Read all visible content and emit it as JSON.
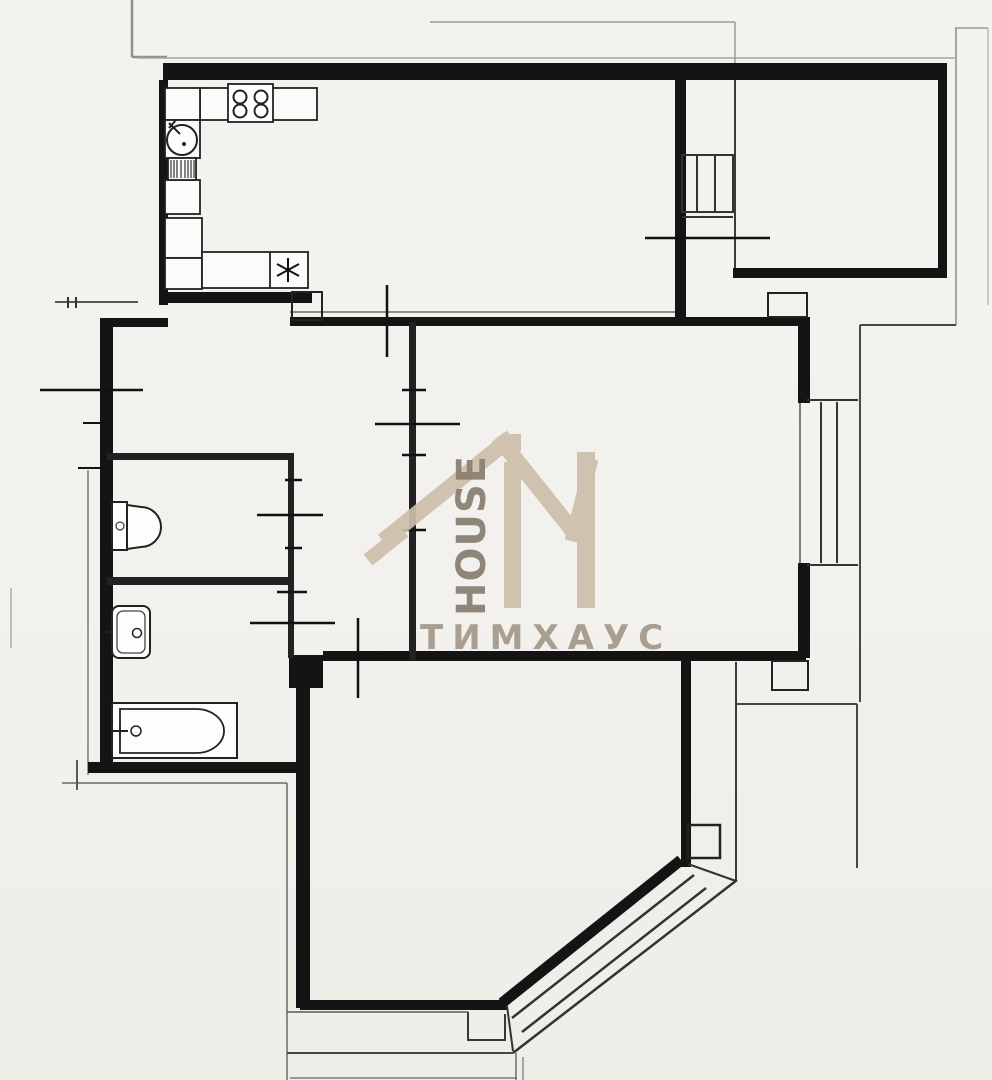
{
  "watermark": {
    "logo_monogram": "TiM",
    "logo_subtext": "HOUSE",
    "brand_name_cyrillic": "ТИМХАУС",
    "colors": {
      "logo_beige": "#ccc0ab",
      "house_text": "#8a8174",
      "cyrillic_text": "#a49b8d"
    }
  },
  "plan": {
    "kind": "scanned apartment floor plan, no text labels",
    "paper_color": "#f3f1ed",
    "wall_color": "#141414",
    "fixtures": [
      {
        "icon": "stove-icon",
        "location": "kitchen top wall",
        "detail": "4 burners"
      },
      {
        "icon": "kitchen-sink-icon",
        "location": "kitchen left counter",
        "detail": "round sink with tap"
      },
      {
        "icon": "striped-appliance-icon",
        "location": "kitchen left counter"
      },
      {
        "icon": "fridge-marker-icon",
        "location": "kitchen lower counter",
        "detail": "asterisk symbol"
      },
      {
        "icon": "toilet-icon",
        "location": "WC room left side"
      },
      {
        "icon": "washbasin-icon",
        "location": "washroom left side"
      },
      {
        "icon": "bathtub-icon",
        "location": "bathroom lower left"
      },
      {
        "icon": "window-icon",
        "location": "living room right wall"
      },
      {
        "icon": "ladder-icon",
        "location": "upper right annex"
      },
      {
        "icon": "stairs-icon",
        "location": "lower right diagonal external stairs"
      }
    ]
  }
}
